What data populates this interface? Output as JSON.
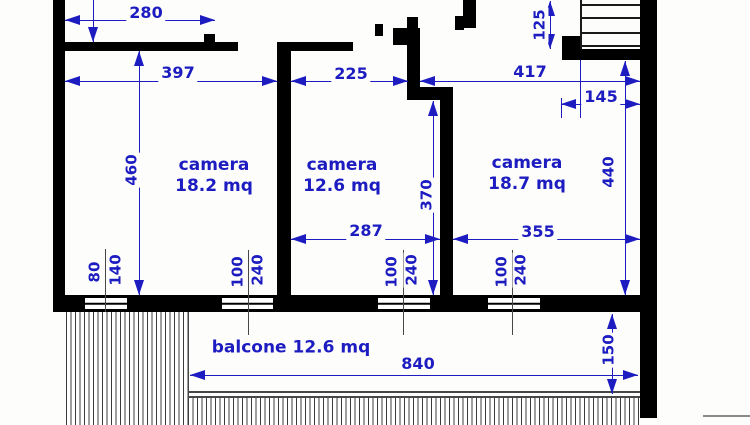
{
  "rooms": [
    {
      "name": "camera",
      "area": "18.2 mq"
    },
    {
      "name": "camera",
      "area": "12.6 mq"
    },
    {
      "name": "camera",
      "area": "18.7 mq"
    }
  ],
  "balcony_label": "balcone 12.6 mq",
  "dims": {
    "d280": "280",
    "d397": "397",
    "d225": "225",
    "d417": "417",
    "d145": "145",
    "d125": "125",
    "d460": "460",
    "d370": "370",
    "d440": "440",
    "d287": "287",
    "d355": "355",
    "d840": "840",
    "d150": "150"
  },
  "windows": [
    {
      "w": "80",
      "h": "140"
    },
    {
      "w": "100",
      "h": "240"
    },
    {
      "w": "100",
      "h": "240"
    },
    {
      "w": "100",
      "h": "240"
    }
  ],
  "colors": {
    "dimension_blue": "#1c1cc0",
    "wall_black": "#000000",
    "hatch_gray": "#3c3c3c"
  }
}
